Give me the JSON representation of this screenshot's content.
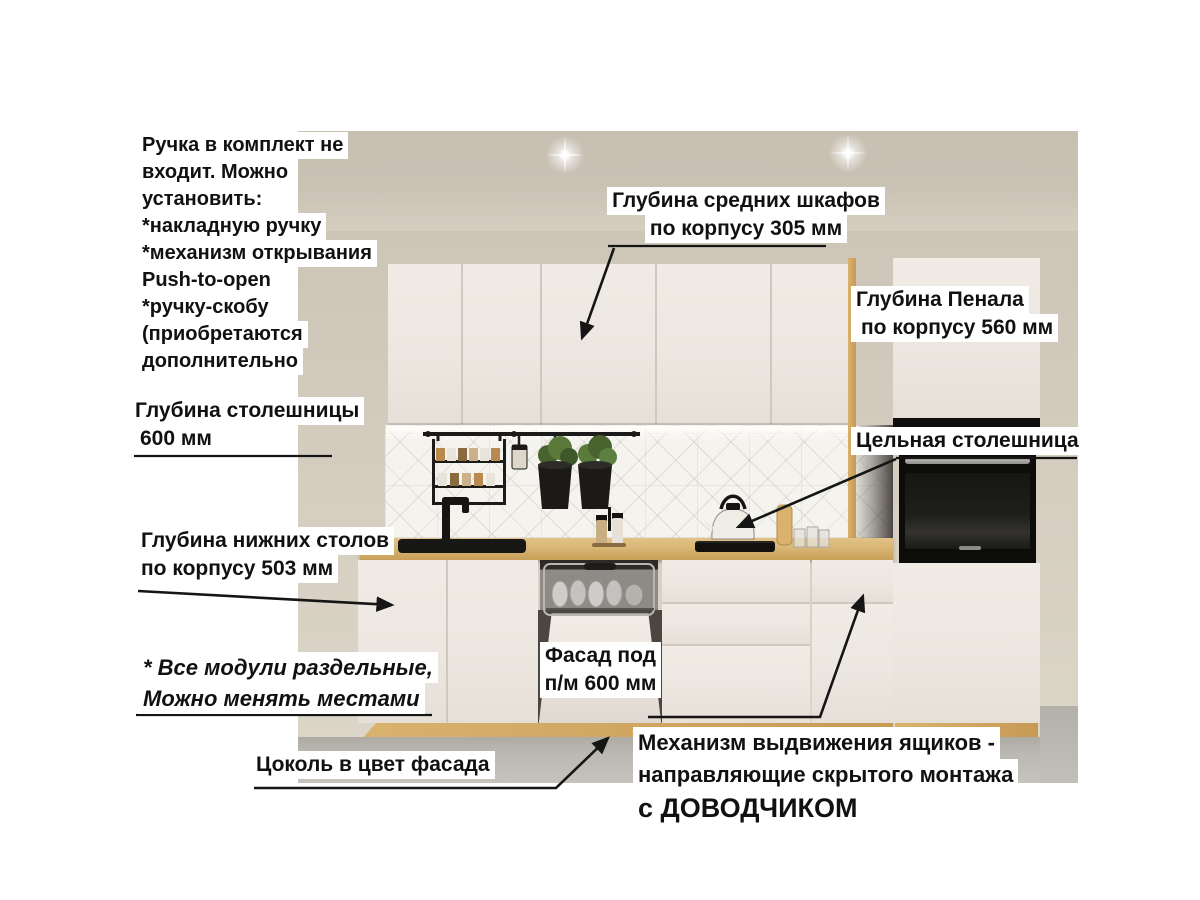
{
  "annotations": {
    "handle_note": {
      "lines": [
        "Ручка в комплект не",
        "входит. Можно",
        "установить:",
        "*накладную ручку",
        "*механизм открывания",
        "Push-to-open",
        "*ручку-скобу",
        "(приобретаются",
        "дополнительно"
      ]
    },
    "mid_cabinet_depth": {
      "lines": [
        "Глубина средних шкафов",
        "по корпусу 305 мм"
      ]
    },
    "penal_depth": {
      "lines": [
        "Глубина Пенала",
        "по корпусу 560 мм"
      ]
    },
    "countertop_depth": {
      "lines": [
        "Глубина столешницы",
        "600 мм"
      ]
    },
    "solid_countertop": {
      "text": "Цельная столешница"
    },
    "base_depth": {
      "lines": [
        "Глубина нижних столов",
        "по корпусу 503 мм"
      ]
    },
    "modules_note": {
      "lines": [
        "* Все модули раздельные,",
        "Можно менять местами"
      ]
    },
    "dishwasher_facade": {
      "lines": [
        "Фасад под",
        "п/м 600 мм"
      ]
    },
    "plinth_note": {
      "text": "Цоколь в цвет фасада"
    },
    "drawer_mechanism": {
      "lines": [
        "Механизм выдвижения ящиков -",
        "направляющие скрытого монтажа"
      ],
      "emphasis": "с ДОВОДЧИКОМ"
    }
  },
  "colors": {
    "annotation_bg": "#ffffff",
    "annotation_text": "#111111",
    "leader": "#151515",
    "wall": "#cdc5b7",
    "cabinet_front": "#ece7e0",
    "countertop_oak": "#d8b676",
    "plinth_oak": "#c79a54",
    "floor": "#bcb9b3",
    "appliance_black": "#0c0c0b"
  }
}
